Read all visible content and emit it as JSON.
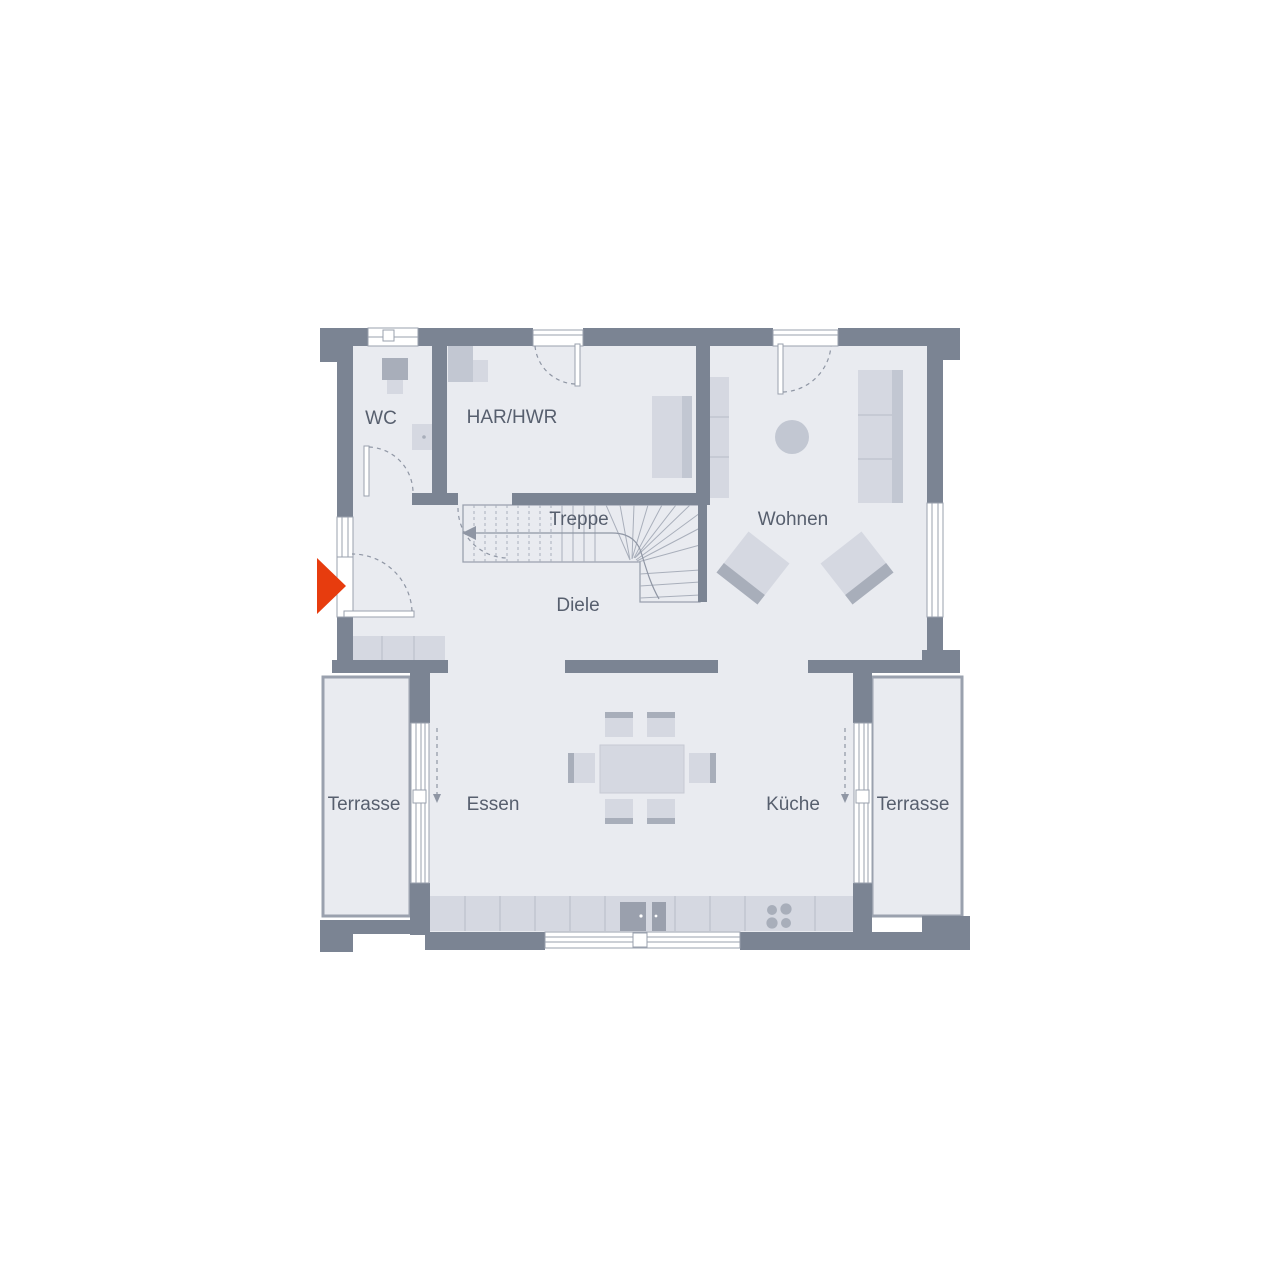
{
  "rooms": [
    {
      "id": "wc",
      "label": "WC"
    },
    {
      "id": "har-hwr",
      "label": "HAR/HWR"
    },
    {
      "id": "treppe",
      "label": "Treppe"
    },
    {
      "id": "wohnen",
      "label": "Wohnen"
    },
    {
      "id": "diele",
      "label": "Diele"
    },
    {
      "id": "terrasse-left",
      "label": "Terrasse"
    },
    {
      "id": "essen",
      "label": "Essen"
    },
    {
      "id": "kueche",
      "label": "Küche"
    },
    {
      "id": "terrasse-right",
      "label": "Terrasse"
    }
  ],
  "palette": {
    "wall": "#7b8493",
    "floor": "#e9ebf0",
    "outline": "#9aa1ae",
    "furniture_light": "#d5d8e1",
    "furniture_mid": "#c2c7d2",
    "furniture_dark": "#a8aeba",
    "appliance": "#9aa0ad",
    "label_text": "#575f6e",
    "accent_red": "#e73c0e"
  }
}
